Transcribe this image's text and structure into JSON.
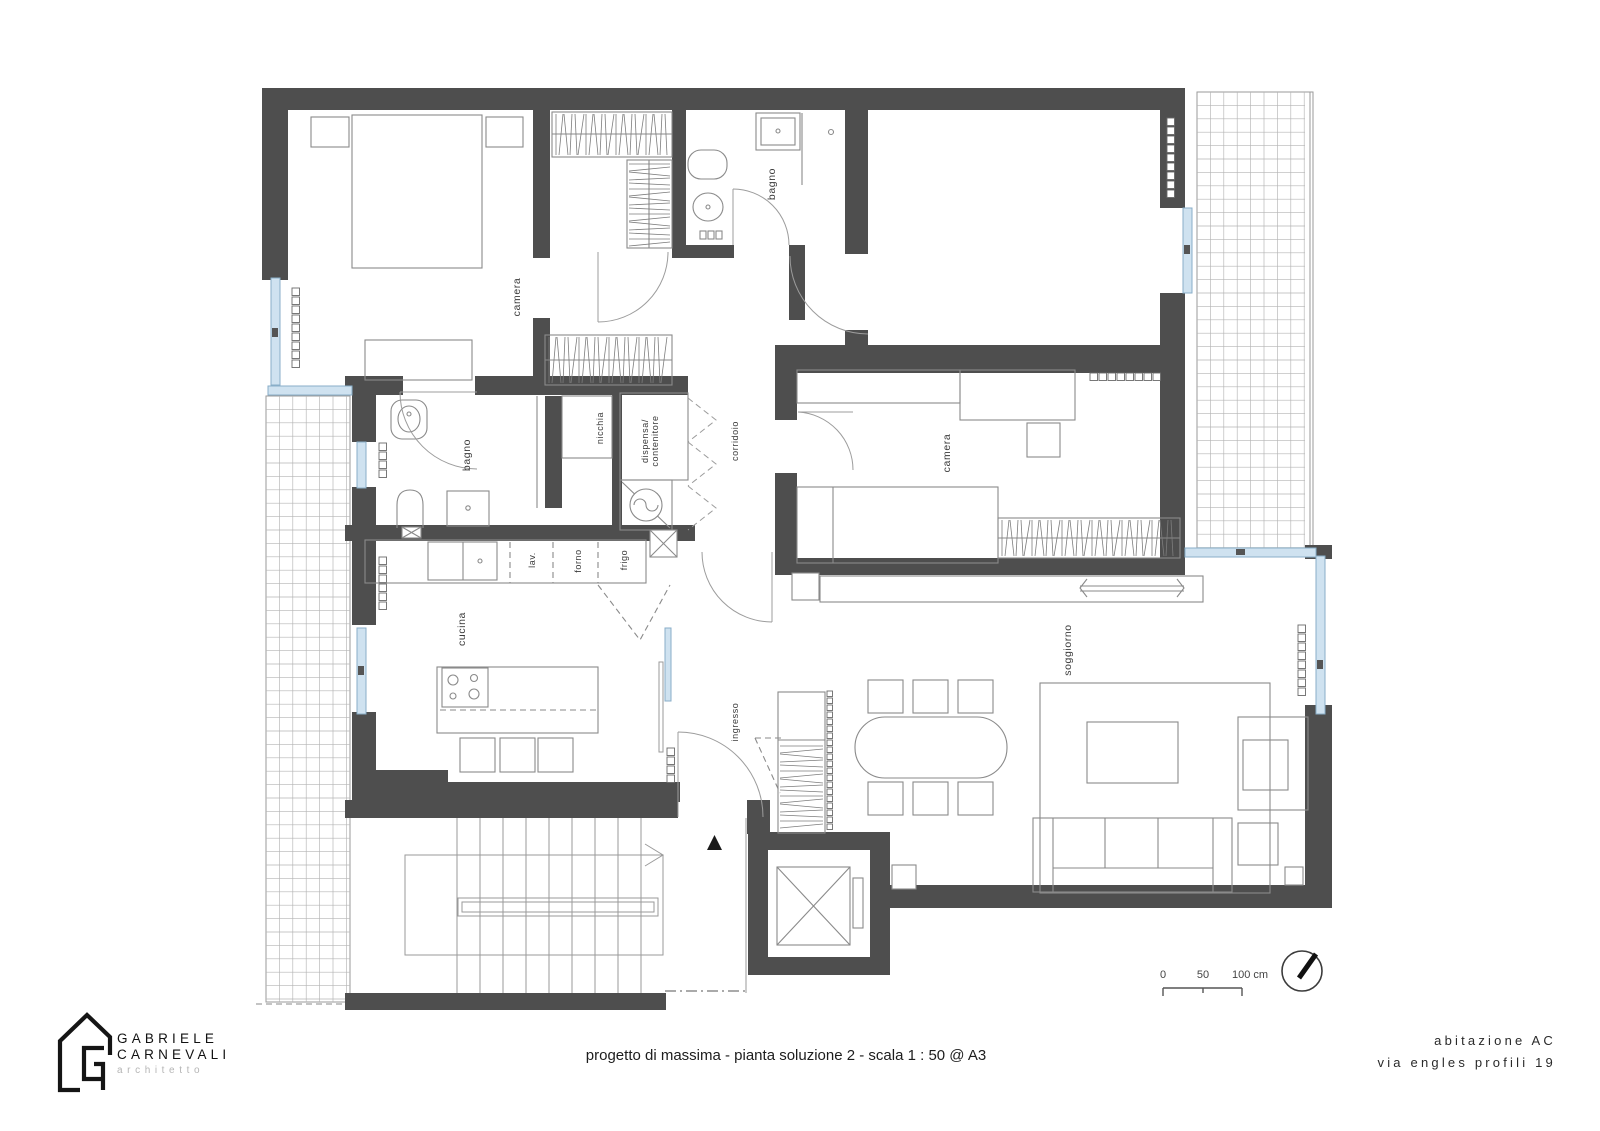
{
  "labels": {
    "camera_nw": "camera",
    "bagno_top": "bagno",
    "camera_east": "camera",
    "bagno_west": "bagno",
    "nicchia": "nicchia",
    "dispensa_line1": "dispensa/",
    "dispensa_line2": "contenitore",
    "corridoio": "corridoio",
    "cucina": "cucina",
    "ingresso": "ingresso",
    "soggiorno": "soggiorno",
    "lav": "lav.",
    "forno": "forno",
    "frigo": "frigo"
  },
  "scale_bar": {
    "start": "0",
    "mid": "50",
    "end": "100 cm"
  },
  "title_block": {
    "title": "progetto di massima - pianta soluzione 2 - scala 1 : 50 @ A3"
  },
  "architect": {
    "first_name": "GABRIELE",
    "last_name": "CARNEVALI",
    "profession": "architetto"
  },
  "project": {
    "name": "abitazione AC",
    "address": "via engles profili 19"
  },
  "colors": {
    "wall": "#4e4e4e",
    "window_fill": "#cfe2f0",
    "window_border": "#88aec8",
    "furniture_line": "#8a8a8a",
    "tile_line": "#b4b4b4"
  }
}
